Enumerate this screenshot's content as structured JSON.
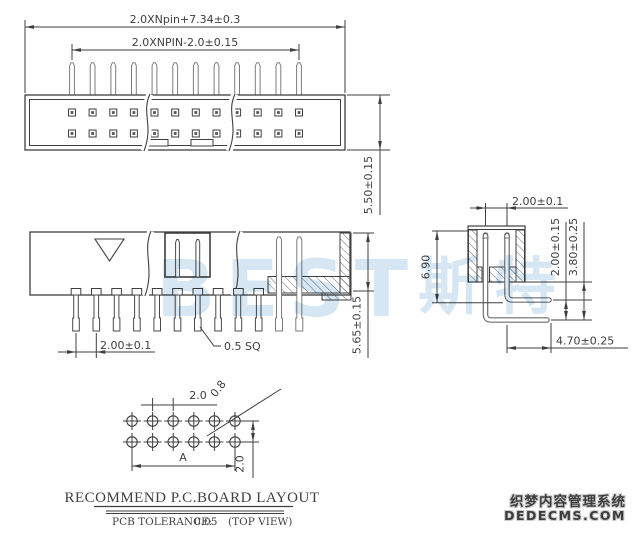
{
  "drawing": {
    "top_view": {
      "dim_overall": "2.0XNpin+7.34±0.3",
      "dim_span": "2.0XNPIN-2.0±0.15",
      "dim_height": "5.50±0.15"
    },
    "front_view": {
      "dim_pitch": "2.00±0.1",
      "dim_pin": "0.5 SQ",
      "dim_height": "5.65±0.15"
    },
    "side_view": {
      "dim_pitch": "2.00±0.1",
      "dim_body": "6.90",
      "dim_row": "2.00±0.15",
      "dim_offset": "3.80±0.25",
      "dim_tail": "4.70±0.25"
    },
    "pcb": {
      "dim_pitch": "2.0",
      "dim_hole": "0.8",
      "dim_span": "A",
      "dim_row": "2.0",
      "title": "RECOMMEND P.C.BOARD LAYOUT",
      "tol_label": "PCB TOLERANCE:",
      "tol_value": "0.05",
      "tol_view": "(TOP VIEW)"
    }
  },
  "watermark": {
    "brand": "BEST",
    "brand_cn": "斯特",
    "footer_line1": "织梦内容管理系统",
    "footer_line2": "DEDECMS.COM"
  },
  "colors": {
    "line": "#3f3f3f",
    "pin_line": "#7d7d7d",
    "watermark_blue": "#b5d3ea",
    "background": "#ffffff"
  }
}
